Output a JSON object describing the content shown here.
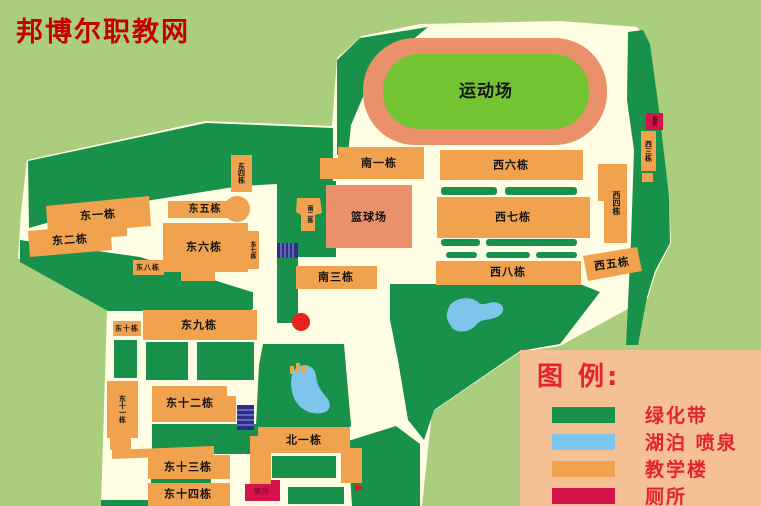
{
  "watermark": {
    "text": "邦博尔职教网",
    "color": "#c40000"
  },
  "map": {
    "areas": {
      "sports_field": "运动场",
      "basketball_court": "篮球场"
    },
    "buildings": {
      "nan1": "南一栋",
      "nan2": "南二栋",
      "nan3": "南三栋",
      "bei1": "北一栋",
      "xi3": "西三栋",
      "xi4": "西四栋",
      "xi5": "西五栋",
      "xi6": "西六栋",
      "xi7": "西七栋",
      "xi8": "西八栋",
      "dong1": "东一栋",
      "dong2": "东二栋",
      "dong4": "东四栋",
      "dong5": "东五栋",
      "dong6": "东六栋",
      "dong7": "东七栋",
      "dong8": "东八栋",
      "dong9": "东九栋",
      "dong10": "东十栋",
      "dong11": "东十一栋",
      "dong12": "东十二栋",
      "dong13": "东十三栋",
      "dong14": "东十四栋"
    },
    "toilets": {
      "t1": "厕所",
      "t2": "厕所"
    }
  },
  "legend": {
    "title": "图 例:",
    "items": [
      {
        "label": "绿化带",
        "color": "#18914a"
      },
      {
        "label": "湖泊 喷泉",
        "color": "#7ec5ec"
      },
      {
        "label": "教学楼",
        "color": "#f0a24e"
      },
      {
        "label": "厕所",
        "color": "#d6134c"
      }
    ]
  },
  "colors": {
    "background": "#abce7e",
    "campus_ground": "#fffde3",
    "green_belt": "#18914a",
    "building": "#f0a24e",
    "track": "#ea916c",
    "field_green": "#74c332",
    "water": "#7ec5ec",
    "toilet": "#d6134c",
    "legend_bg": "#f5c094",
    "legend_text": "#e52330",
    "marker_red": "#e8231a",
    "stairs_navy": "#2c2f8a"
  }
}
